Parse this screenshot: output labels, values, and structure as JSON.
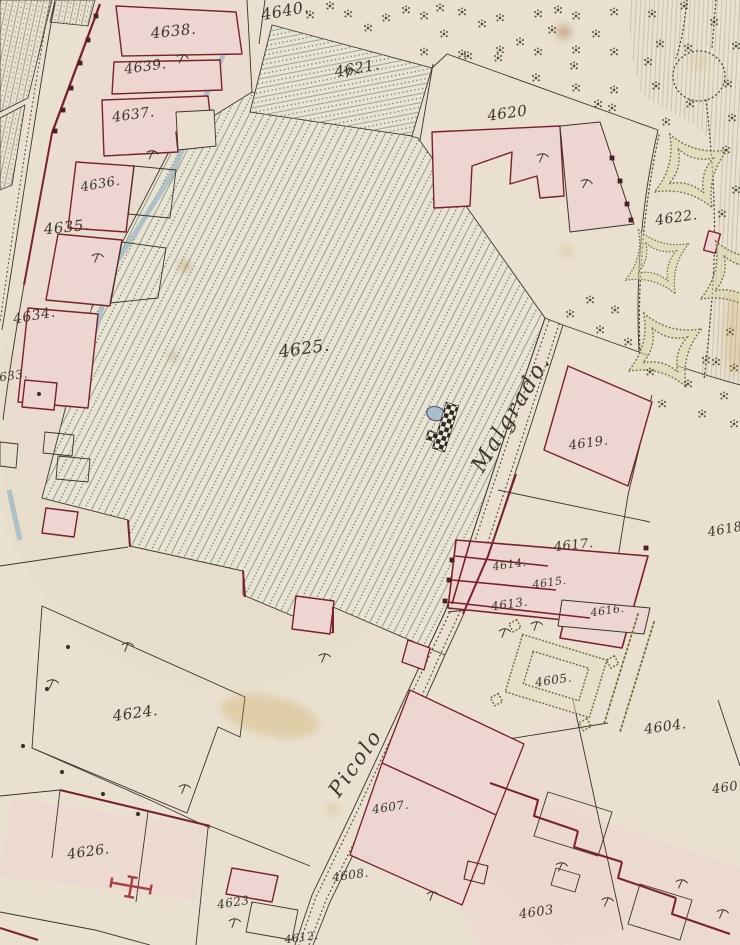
{
  "map": {
    "type": "historical cadastral plan (scanned sheet)",
    "colors": {
      "paper": "#e9e0cf",
      "building_fill": "#edd5d2",
      "wall_red": "#7b2030",
      "line": "#3b342b",
      "hatch": "#8f927e",
      "garden_green": "#6d7040",
      "water_blue": "#a3bcc4",
      "tree": "#4b4e31",
      "label_ink": "#3e372b",
      "stain": "#c9a148"
    },
    "street_labels": [
      {
        "text": "Malgrado.",
        "x": 517,
        "y": 417,
        "rot": -59,
        "size": 22
      },
      {
        "text": "Picolo",
        "x": 361,
        "y": 767,
        "rot": -55,
        "size": 21
      }
    ],
    "parcel_labels": [
      {
        "text": "4640.",
        "x": 286,
        "y": 16,
        "rot": -10,
        "size": 16
      },
      {
        "text": "4638.",
        "x": 174,
        "y": 36,
        "rot": -6,
        "size": 15
      },
      {
        "text": "4639.",
        "x": 146,
        "y": 71,
        "rot": -8,
        "size": 14
      },
      {
        "text": "4637.",
        "x": 134,
        "y": 119,
        "rot": -8,
        "size": 14
      },
      {
        "text": "4636.",
        "x": 101,
        "y": 188,
        "rot": -10,
        "size": 13
      },
      {
        "text": "4635.",
        "x": 67,
        "y": 232,
        "rot": -6,
        "size": 15
      },
      {
        "text": "4634.",
        "x": 35,
        "y": 320,
        "rot": -10,
        "size": 14
      },
      {
        "text": "4633.",
        "x": 10,
        "y": 380,
        "rot": -8,
        "size": 12
      },
      {
        "text": "4625.",
        "x": 305,
        "y": 354,
        "rot": -8,
        "size": 17
      },
      {
        "text": "4621.",
        "x": 358,
        "y": 73,
        "rot": -10,
        "size": 15
      },
      {
        "text": "4620",
        "x": 508,
        "y": 118,
        "rot": -8,
        "size": 15
      },
      {
        "text": "4622.",
        "x": 677,
        "y": 222,
        "rot": -8,
        "size": 14
      },
      {
        "text": "4619.",
        "x": 589,
        "y": 447,
        "rot": -8,
        "size": 13
      },
      {
        "text": "4617.",
        "x": 574,
        "y": 549,
        "rot": -6,
        "size": 13
      },
      {
        "text": "4614.",
        "x": 510,
        "y": 568,
        "rot": -8,
        "size": 11
      },
      {
        "text": "4615.",
        "x": 550,
        "y": 586,
        "rot": -8,
        "size": 11
      },
      {
        "text": "4613.",
        "x": 510,
        "y": 608,
        "rot": -8,
        "size": 12
      },
      {
        "text": "4616.",
        "x": 608,
        "y": 614,
        "rot": -8,
        "size": 11
      },
      {
        "text": "4618.",
        "x": 728,
        "y": 533,
        "rot": -10,
        "size": 13
      },
      {
        "text": "4605.",
        "x": 554,
        "y": 684,
        "rot": -8,
        "size": 12
      },
      {
        "text": "4604.",
        "x": 666,
        "y": 731,
        "rot": -8,
        "size": 14
      },
      {
        "text": "4601",
        "x": 730,
        "y": 791,
        "rot": -8,
        "size": 13
      },
      {
        "text": "4624.",
        "x": 136,
        "y": 718,
        "rot": -8,
        "size": 15
      },
      {
        "text": "4626.",
        "x": 89,
        "y": 856,
        "rot": -8,
        "size": 14
      },
      {
        "text": "4623.",
        "x": 236,
        "y": 906,
        "rot": -8,
        "size": 12
      },
      {
        "text": "4607.",
        "x": 391,
        "y": 811,
        "rot": -8,
        "size": 12
      },
      {
        "text": "4608.",
        "x": 351,
        "y": 879,
        "rot": -8,
        "size": 12
      },
      {
        "text": "4603",
        "x": 537,
        "y": 916,
        "rot": -8,
        "size": 13
      },
      {
        "text": "4612.",
        "x": 302,
        "y": 941,
        "rot": -8,
        "size": 11
      }
    ]
  }
}
